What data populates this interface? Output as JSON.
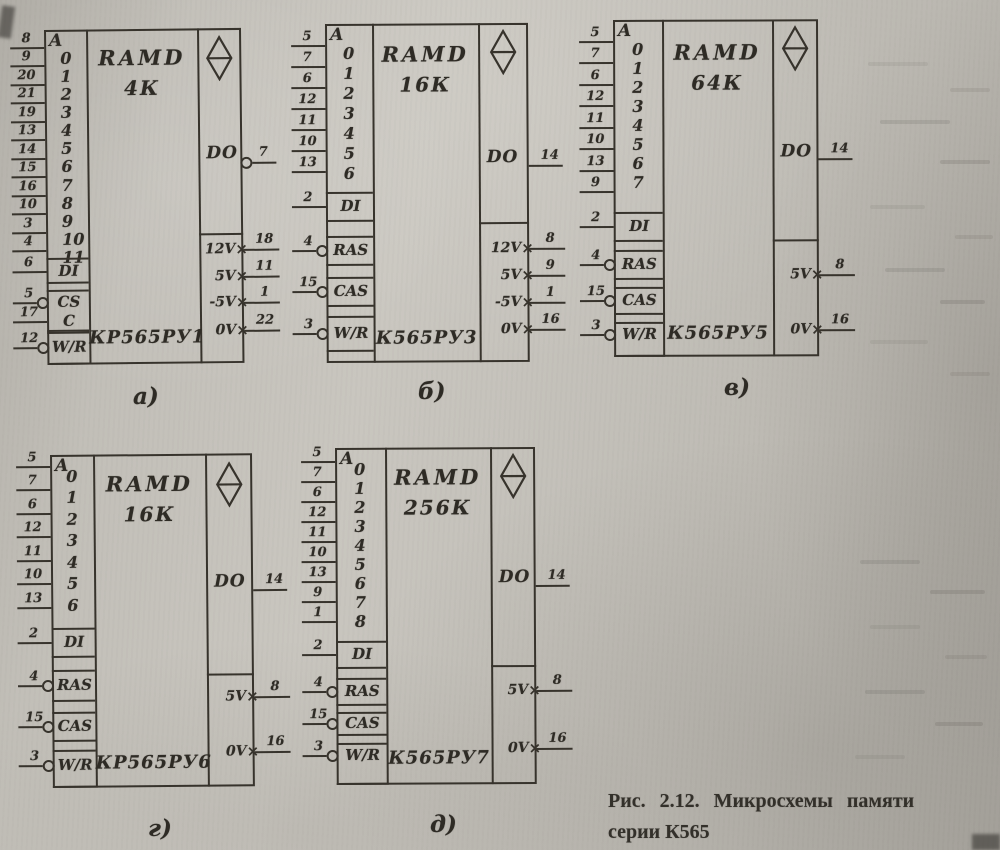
{
  "figure": {
    "caption_line1": "Рис. 2.12. Микросхемы памяти",
    "caption_line2": "серии К565"
  },
  "colors": {
    "ink": "#37332c",
    "paper": "#c0bdb6"
  },
  "icons": {
    "chip_symbol": "rhombus-with-horizontal-bar-icon",
    "inversion_marker": "circle-bubble-icon",
    "power_pin_marker": "x-cross-icon"
  },
  "chips": [
    {
      "id": "a",
      "label": "а)",
      "ram_type": "RAMD",
      "capacity": "4К",
      "part_number": "КР565РУ1",
      "address_header": "A",
      "address_pins": [
        {
          "bit": "0",
          "pin": "8"
        },
        {
          "bit": "1",
          "pin": "9"
        },
        {
          "bit": "2",
          "pin": "20"
        },
        {
          "bit": "3",
          "pin": "21"
        },
        {
          "bit": "4",
          "pin": "19"
        },
        {
          "bit": "5",
          "pin": "13"
        },
        {
          "bit": "6",
          "pin": "14"
        },
        {
          "bit": "7",
          "pin": "15"
        },
        {
          "bit": "8",
          "pin": "16"
        },
        {
          "bit": "9",
          "pin": "10"
        },
        {
          "bit": "10",
          "pin": "3"
        },
        {
          "bit": "11",
          "pin": "4"
        }
      ],
      "control_pins": [
        {
          "name": "DI",
          "pin": "6",
          "bubble": false
        },
        {
          "name": "CS",
          "pin": "5",
          "bubble": true
        },
        {
          "name": "C",
          "pin": "17",
          "bubble": false
        },
        {
          "name": "W/R",
          "pin": "12",
          "bubble": true
        }
      ],
      "output_pin": {
        "name": "DO",
        "pin": "7",
        "bubble": true
      },
      "power_pins": [
        {
          "name": "12V",
          "pin": "18"
        },
        {
          "name": "5V",
          "pin": "11"
        },
        {
          "name": "-5V",
          "pin": "1"
        },
        {
          "name": "0V",
          "pin": "22"
        }
      ]
    },
    {
      "id": "b",
      "label": "б)",
      "ram_type": "RAMD",
      "capacity": "16К",
      "part_number": "К565РУ3",
      "address_header": "A",
      "address_pins": [
        {
          "bit": "0",
          "pin": "5"
        },
        {
          "bit": "1",
          "pin": "7"
        },
        {
          "bit": "2",
          "pin": "6"
        },
        {
          "bit": "3",
          "pin": "12"
        },
        {
          "bit": "4",
          "pin": "11"
        },
        {
          "bit": "5",
          "pin": "10"
        },
        {
          "bit": "6",
          "pin": "13"
        }
      ],
      "control_pins": [
        {
          "name": "DI",
          "pin": "2",
          "bubble": false
        },
        {
          "name": "RAS",
          "pin": "4",
          "bubble": true
        },
        {
          "name": "CAS",
          "pin": "15",
          "bubble": true
        },
        {
          "name": "W/R",
          "pin": "3",
          "bubble": true
        }
      ],
      "output_pin": {
        "name": "DO",
        "pin": "14",
        "bubble": false
      },
      "power_pins": [
        {
          "name": "12V",
          "pin": "8"
        },
        {
          "name": "5V",
          "pin": "9"
        },
        {
          "name": "-5V",
          "pin": "1"
        },
        {
          "name": "0V",
          "pin": "16"
        }
      ]
    },
    {
      "id": "v",
      "label": "в)",
      "ram_type": "RAMD",
      "capacity": "64К",
      "part_number": "К565РУ5",
      "address_header": "A",
      "address_pins": [
        {
          "bit": "0",
          "pin": "5"
        },
        {
          "bit": "1",
          "pin": "7"
        },
        {
          "bit": "2",
          "pin": "6"
        },
        {
          "bit": "3",
          "pin": "12"
        },
        {
          "bit": "4",
          "pin": "11"
        },
        {
          "bit": "5",
          "pin": "10"
        },
        {
          "bit": "6",
          "pin": "13"
        },
        {
          "bit": "7",
          "pin": "9"
        }
      ],
      "control_pins": [
        {
          "name": "DI",
          "pin": "2",
          "bubble": false
        },
        {
          "name": "RAS",
          "pin": "4",
          "bubble": true
        },
        {
          "name": "CAS",
          "pin": "15",
          "bubble": true
        },
        {
          "name": "W/R",
          "pin": "3",
          "bubble": true
        }
      ],
      "output_pin": {
        "name": "DO",
        "pin": "14",
        "bubble": false
      },
      "power_pins": [
        {
          "name": "5V",
          "pin": "8"
        },
        {
          "name": "0V",
          "pin": "16"
        }
      ]
    },
    {
      "id": "g",
      "label": "г)",
      "ram_type": "RAMD",
      "capacity": "16К",
      "part_number": "КР565РУ6",
      "address_header": "A",
      "address_pins": [
        {
          "bit": "0",
          "pin": "5"
        },
        {
          "bit": "1",
          "pin": "7"
        },
        {
          "bit": "2",
          "pin": "6"
        },
        {
          "bit": "3",
          "pin": "12"
        },
        {
          "bit": "4",
          "pin": "11"
        },
        {
          "bit": "5",
          "pin": "10"
        },
        {
          "bit": "6",
          "pin": "13"
        }
      ],
      "control_pins": [
        {
          "name": "DI",
          "pin": "2",
          "bubble": false
        },
        {
          "name": "RAS",
          "pin": "4",
          "bubble": true
        },
        {
          "name": "CAS",
          "pin": "15",
          "bubble": true
        },
        {
          "name": "W/R",
          "pin": "3",
          "bubble": true
        }
      ],
      "output_pin": {
        "name": "DO",
        "pin": "14",
        "bubble": false
      },
      "power_pins": [
        {
          "name": "5V",
          "pin": "8"
        },
        {
          "name": "0V",
          "pin": "16"
        }
      ]
    },
    {
      "id": "d",
      "label": "д)",
      "ram_type": "RAMD",
      "capacity": "256К",
      "part_number": "К565РУ7",
      "address_header": "A",
      "address_pins": [
        {
          "bit": "0",
          "pin": "5"
        },
        {
          "bit": "1",
          "pin": "7"
        },
        {
          "bit": "2",
          "pin": "6"
        },
        {
          "bit": "3",
          "pin": "12"
        },
        {
          "bit": "4",
          "pin": "11"
        },
        {
          "bit": "5",
          "pin": "10"
        },
        {
          "bit": "6",
          "pin": "13"
        },
        {
          "bit": "7",
          "pin": "9"
        },
        {
          "bit": "8",
          "pin": "1"
        }
      ],
      "control_pins": [
        {
          "name": "DI",
          "pin": "2",
          "bubble": false
        },
        {
          "name": "RAS",
          "pin": "4",
          "bubble": true
        },
        {
          "name": "CAS",
          "pin": "15",
          "bubble": true
        },
        {
          "name": "W/R",
          "pin": "3",
          "bubble": true
        }
      ],
      "output_pin": {
        "name": "DO",
        "pin": "14",
        "bubble": false
      },
      "power_pins": [
        {
          "name": "5V",
          "pin": "8"
        },
        {
          "name": "0V",
          "pin": "16"
        }
      ]
    }
  ]
}
